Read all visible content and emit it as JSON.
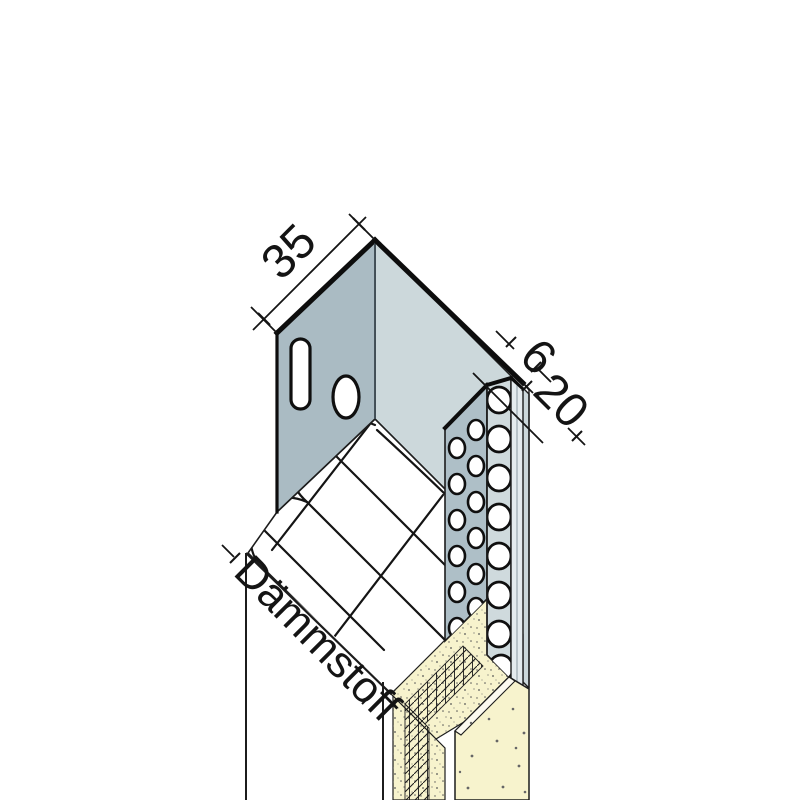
{
  "drawing": {
    "type": "technical-isometric-detail",
    "dimensions": {
      "flange_width": "35",
      "return_depth": "6",
      "bead_width": "20"
    },
    "labels": {
      "insulation": "Dämmstoff"
    },
    "colors": {
      "face_dark": "#aabbc3",
      "face_light": "#ccd8db",
      "bead_wing": "#aebfc7",
      "bead_face": "#cfdadd",
      "bead_edge": "#e4ebee",
      "plaster": "#f7f3cd",
      "plaster_light": "#fcfaf0",
      "line": "#141414",
      "background": "#ffffff"
    }
  }
}
